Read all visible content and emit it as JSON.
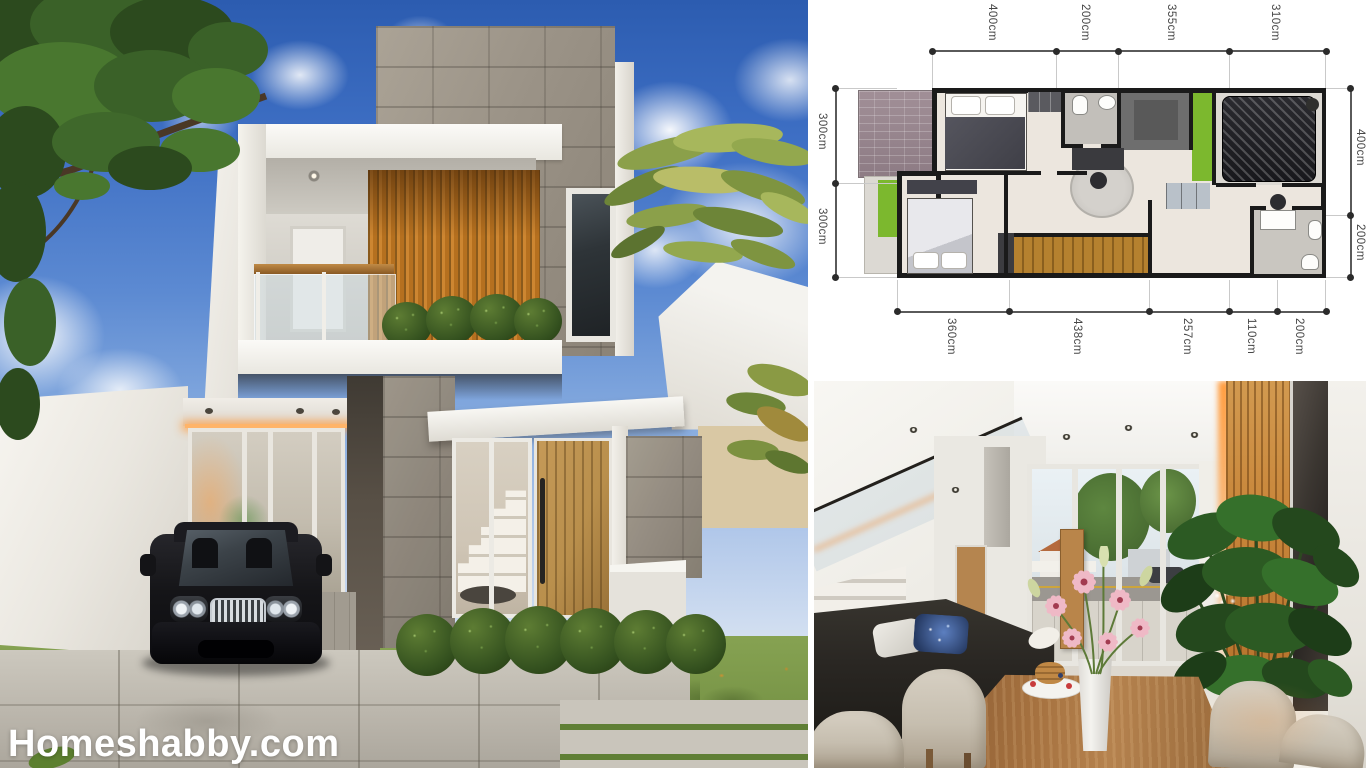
{
  "watermark": {
    "text": "Homeshabby.com"
  },
  "floor_plan": {
    "unit": "cm",
    "top_dims": [
      "400cm",
      "200cm",
      "355cm",
      "310cm"
    ],
    "left_dims": [
      "300cm",
      "300cm"
    ],
    "right_dims": [
      "400cm",
      "200cm"
    ],
    "bottom_dims": [
      "360cm",
      "438cm",
      "257cm",
      "110cm",
      "200cm"
    ]
  },
  "colors": {
    "sky_blue": "#3f6fc4",
    "wood_accent": "#c9873b",
    "stone_gray": "#9d968c",
    "grass_green": "#7d9b4a",
    "plan_garden_green": "#7cb82e",
    "plan_wall_black": "#1a1a1a",
    "plan_wood_stairs": "#b5812f",
    "watermark_white": "#ffffff"
  }
}
